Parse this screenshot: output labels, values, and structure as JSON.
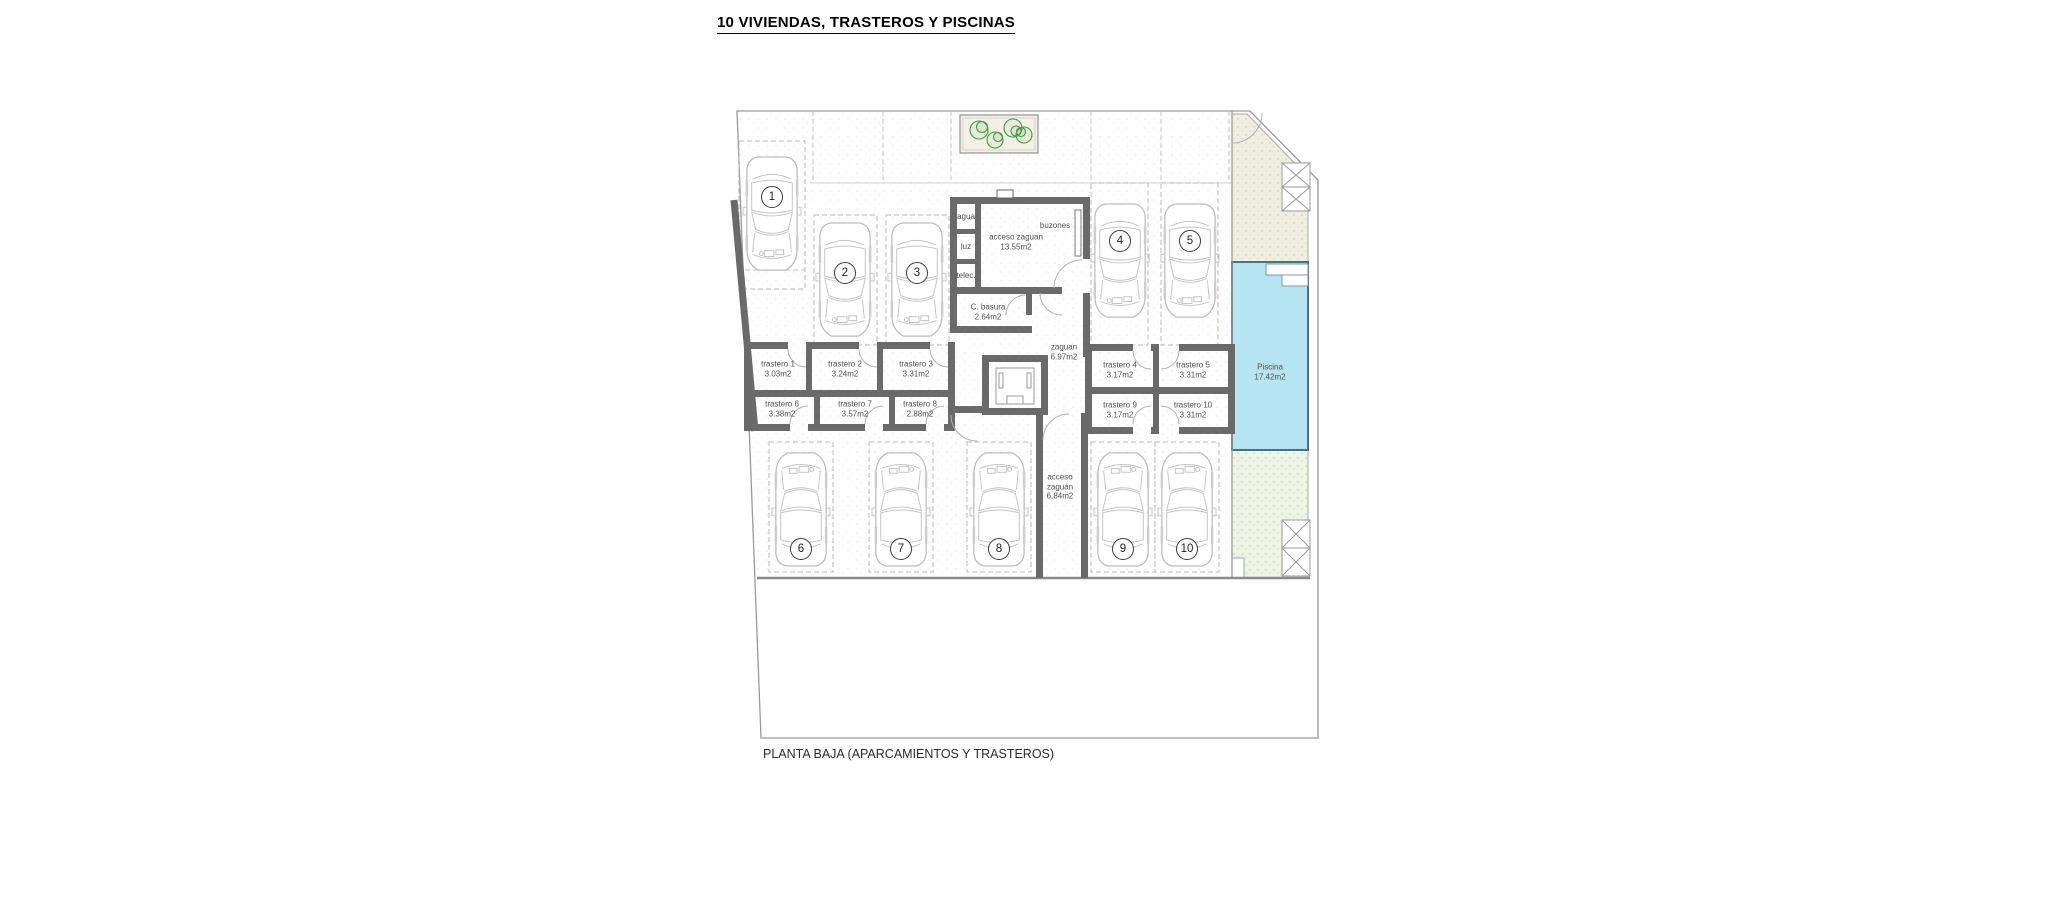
{
  "title": "10 VIVIENDAS, TRASTEROS Y PISCINAS",
  "caption": "PLANTA BAJA (APARCAMIENTOS Y TRASTEROS)",
  "parking": [
    "1",
    "2",
    "3",
    "4",
    "5",
    "6",
    "7",
    "8",
    "9",
    "10"
  ],
  "rooms": {
    "agua": "agua",
    "luz": "luz",
    "telec": "telec.",
    "buzones": "buzones",
    "acceso_zaguan": {
      "name": "acceso zaguan",
      "area": "13.55m2"
    },
    "basura": {
      "name": "C. basura",
      "area": "2.64m2"
    },
    "zaguan": {
      "name": "zaguan",
      "area": "6.97m2"
    },
    "acceso_zaguan_sur": {
      "line1": "acceso",
      "line2": "zaguán",
      "area": "6.84m2"
    },
    "piscina": {
      "name": "Piscina",
      "area": "17.42m2"
    }
  },
  "trasteros": [
    {
      "name": "trastero 1",
      "area": "3.03m2"
    },
    {
      "name": "trastero 2",
      "area": "3.24m2"
    },
    {
      "name": "trastero 3",
      "area": "3.31m2"
    },
    {
      "name": "trastero 4",
      "area": "3.17m2"
    },
    {
      "name": "trastero 5",
      "area": "3.31m2"
    },
    {
      "name": "trastero 6",
      "area": "3.38m2"
    },
    {
      "name": "trastero 7",
      "area": "3.57m2"
    },
    {
      "name": "trastero 8",
      "area": "2.88m2"
    },
    {
      "name": "trastero 9",
      "area": "3.17m2"
    },
    {
      "name": "trastero 10",
      "area": "3.31m2"
    }
  ],
  "colors": {
    "pool_fill": "#b5e4f3",
    "pool_border": "#4a7181",
    "garden_green": "#edf4e6",
    "paving_cream": "#f0eee1",
    "wall_gray": "#6a6a6a",
    "tree_green": "#3f9b3f"
  }
}
